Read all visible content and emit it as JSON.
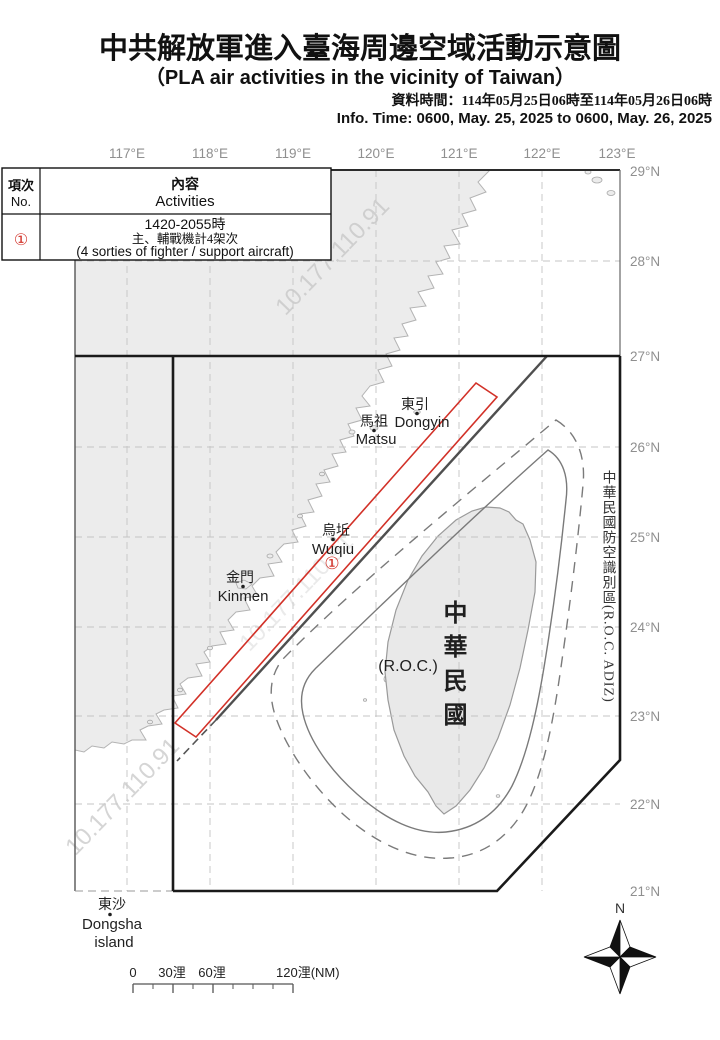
{
  "header": {
    "title_zh": "中共解放軍進入臺海周邊空域活動示意圖",
    "title_en": "（PLA air activities in the vicinity of Taiwan）",
    "data_time_zh": "資料時間：114年05月25日06時至114年05月26日06時",
    "info_time_en": "Info. Time: 0600, May. 25, 2025 to 0600, May. 26, 2025"
  },
  "info_table": {
    "col_no_zh": "項次",
    "col_no_en": "No.",
    "col_act_zh": "內容",
    "col_act_en": "Activities",
    "row": {
      "no": "①",
      "time": "1420-2055時",
      "desc_zh": "主、輔戰機計4架次",
      "desc_en": "(4 sorties of fighter / support aircraft)"
    }
  },
  "map": {
    "lon_ticks": [
      "117°E",
      "118°E",
      "119°E",
      "120°E",
      "121°E",
      "122°E",
      "123°E"
    ],
    "lat_ticks": [
      "29°N",
      "28°N",
      "27°N",
      "26°N",
      "25°N",
      "24°N",
      "23°N",
      "22°N",
      "21°N"
    ],
    "adiz_label": "中華民國防空識別區(R.O.C. ADIZ)",
    "places": {
      "dongyin_zh": "東引",
      "dongyin_en": "Dongyin",
      "matsu_zh": "馬祖",
      "matsu_en": "Matsu",
      "wuqiu_zh": "烏坵",
      "wuqiu_en": "Wuqiu",
      "kinmen_zh": "金門",
      "kinmen_en": "Kinmen",
      "dongsha_zh": "東沙",
      "dongsha_en": "Dongsha",
      "dongsha_en2": "island",
      "taiwan_zh": "中華民國",
      "taiwan_en": "(R.O.C.)"
    },
    "event_marker": "①",
    "watermark": "10.177.110.91"
  },
  "scalebar": {
    "labels": [
      "0",
      "30浬",
      "60浬",
      "120浬(NM)"
    ]
  },
  "compass": {
    "north": "N"
  },
  "colors": {
    "activity_red": "#d23128",
    "adiz_black": "#1a1a1a",
    "land_gray": "#ececec",
    "watermark_gray": "#cbcbcb",
    "tick_gray": "#8f8f8f"
  }
}
